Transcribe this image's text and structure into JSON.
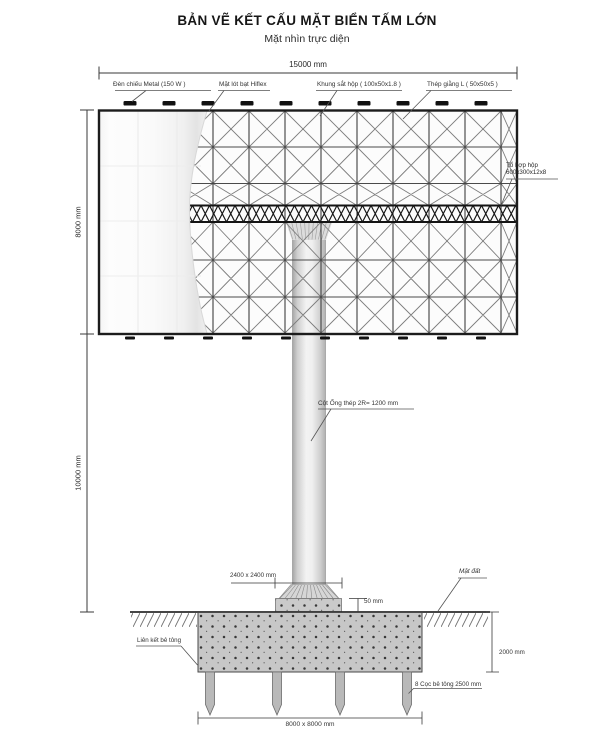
{
  "header": {
    "title": "BẢN VẼ KẾT CẤU MẶT BIỂN TẤM LỚN",
    "subtitle": "Mặt nhìn trực diện"
  },
  "dims": {
    "board_width": "15000 mm",
    "board_height": "8000 mm",
    "pole_height": "10000 mm",
    "base_plate": "2400 x 2400 mm",
    "plate_offset": "50 mm",
    "foundation_depth": "2000 mm",
    "foundation_plan": "8000 x 8000 mm"
  },
  "callouts": {
    "lamp": "Đèn chiếu Metal (150 W )",
    "hiflex": "Mặt lót bạt Hiflex",
    "frame": "Khung sắt hộp ( 100x50x1.8 )",
    "brace": "Thép giằng L ( 50x50x5 )",
    "box_beam_line1": "Tổ hợp hộp",
    "box_beam_line2": "600x300x12x8",
    "pole": "Cột Ống thép 2R= 1200 mm",
    "ground": "Mặt đất",
    "concrete_link": "Liên kết bê tông",
    "piles": "8 Cọc bê tông 2500 mm"
  },
  "colors": {
    "ink": "#1c1c1c",
    "steel_gray": "#d9d9d9",
    "concrete_gray": "#c7c7c7"
  }
}
